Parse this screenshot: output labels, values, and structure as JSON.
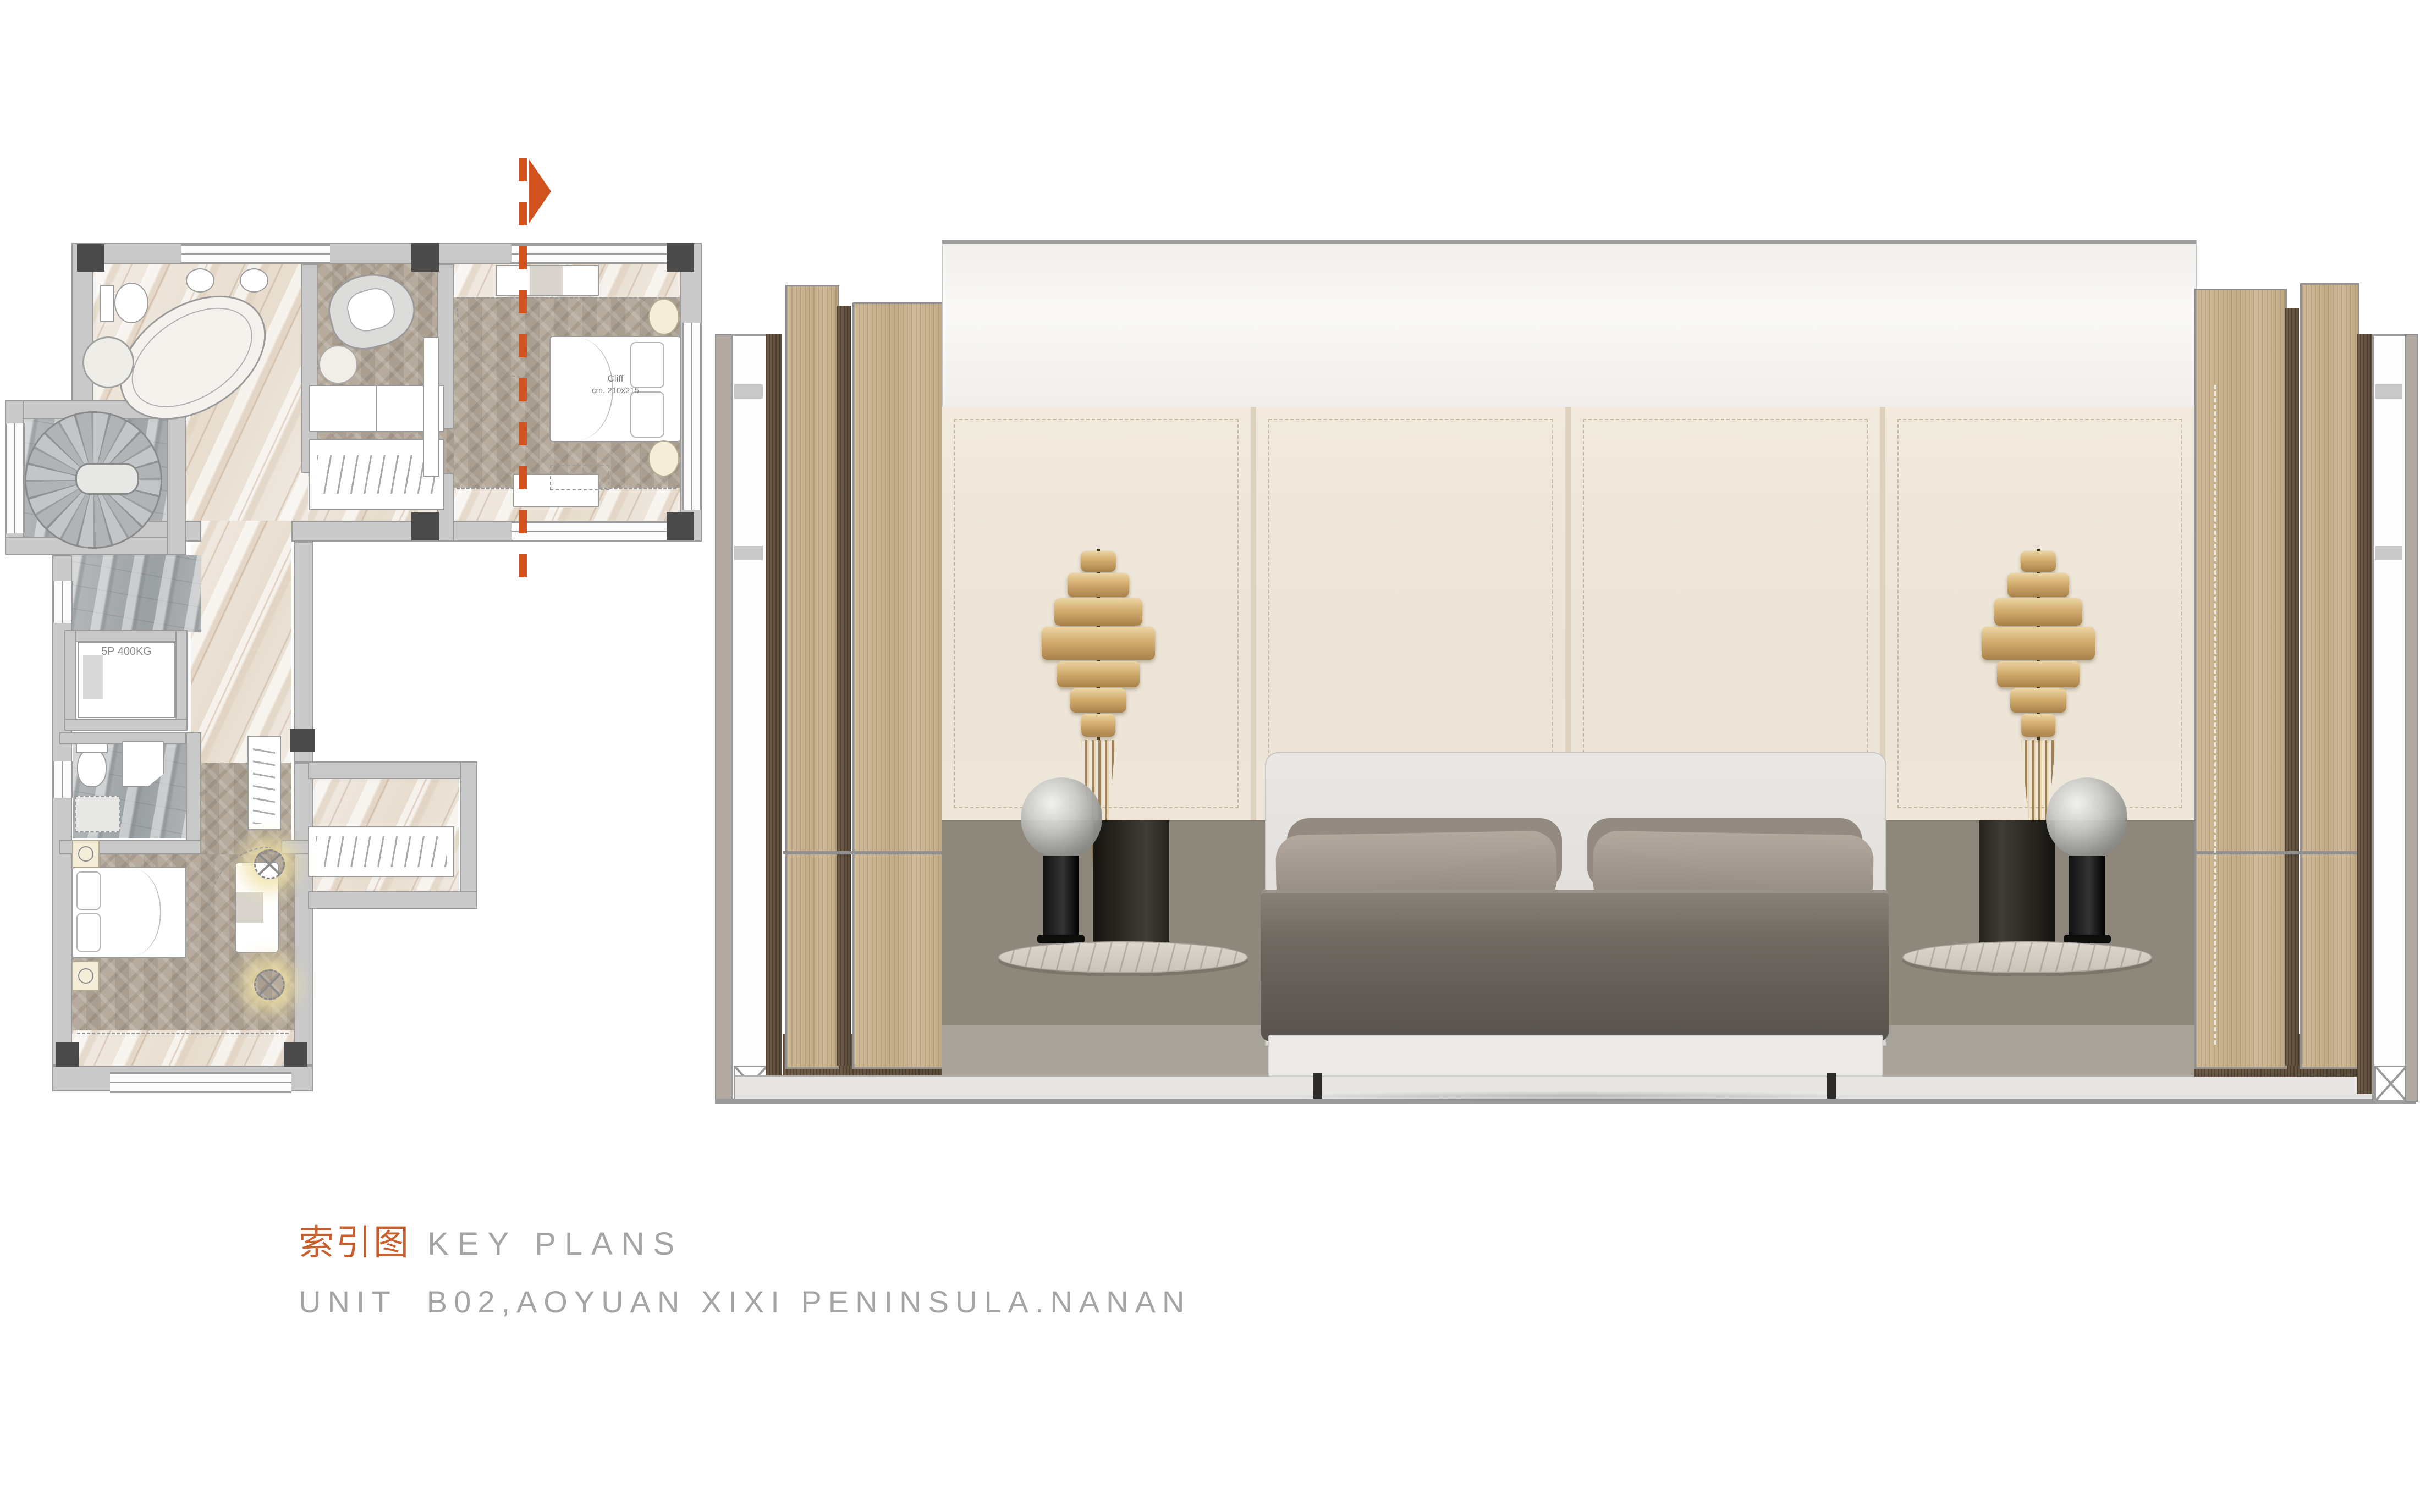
{
  "title_block": {
    "title_cn": "索引图",
    "title_en": "KEY PLANS",
    "subtitle": "UNIT  B02,AOYUAN XIXI PENINSULA.NANAN",
    "accent_color": "#c85f2e",
    "text_color": "#a3a5a7"
  },
  "key_plan": {
    "section_line_color": "#d1511f",
    "labels": {
      "bed_model": "Cliff",
      "bed_size": "cm. 210x215",
      "elevator": "5P 400KG"
    }
  },
  "elevation": {
    "materials": {
      "oak_panel": "#c7b290",
      "dark_oak_groove": "#5e5142",
      "leather_panel": "#efe8db",
      "taupe_band": "#8e877b",
      "ceiling_band": "#f4f2ef",
      "floor_strip": "#e7e6e4",
      "sconce_gold": "#c8a364"
    }
  }
}
